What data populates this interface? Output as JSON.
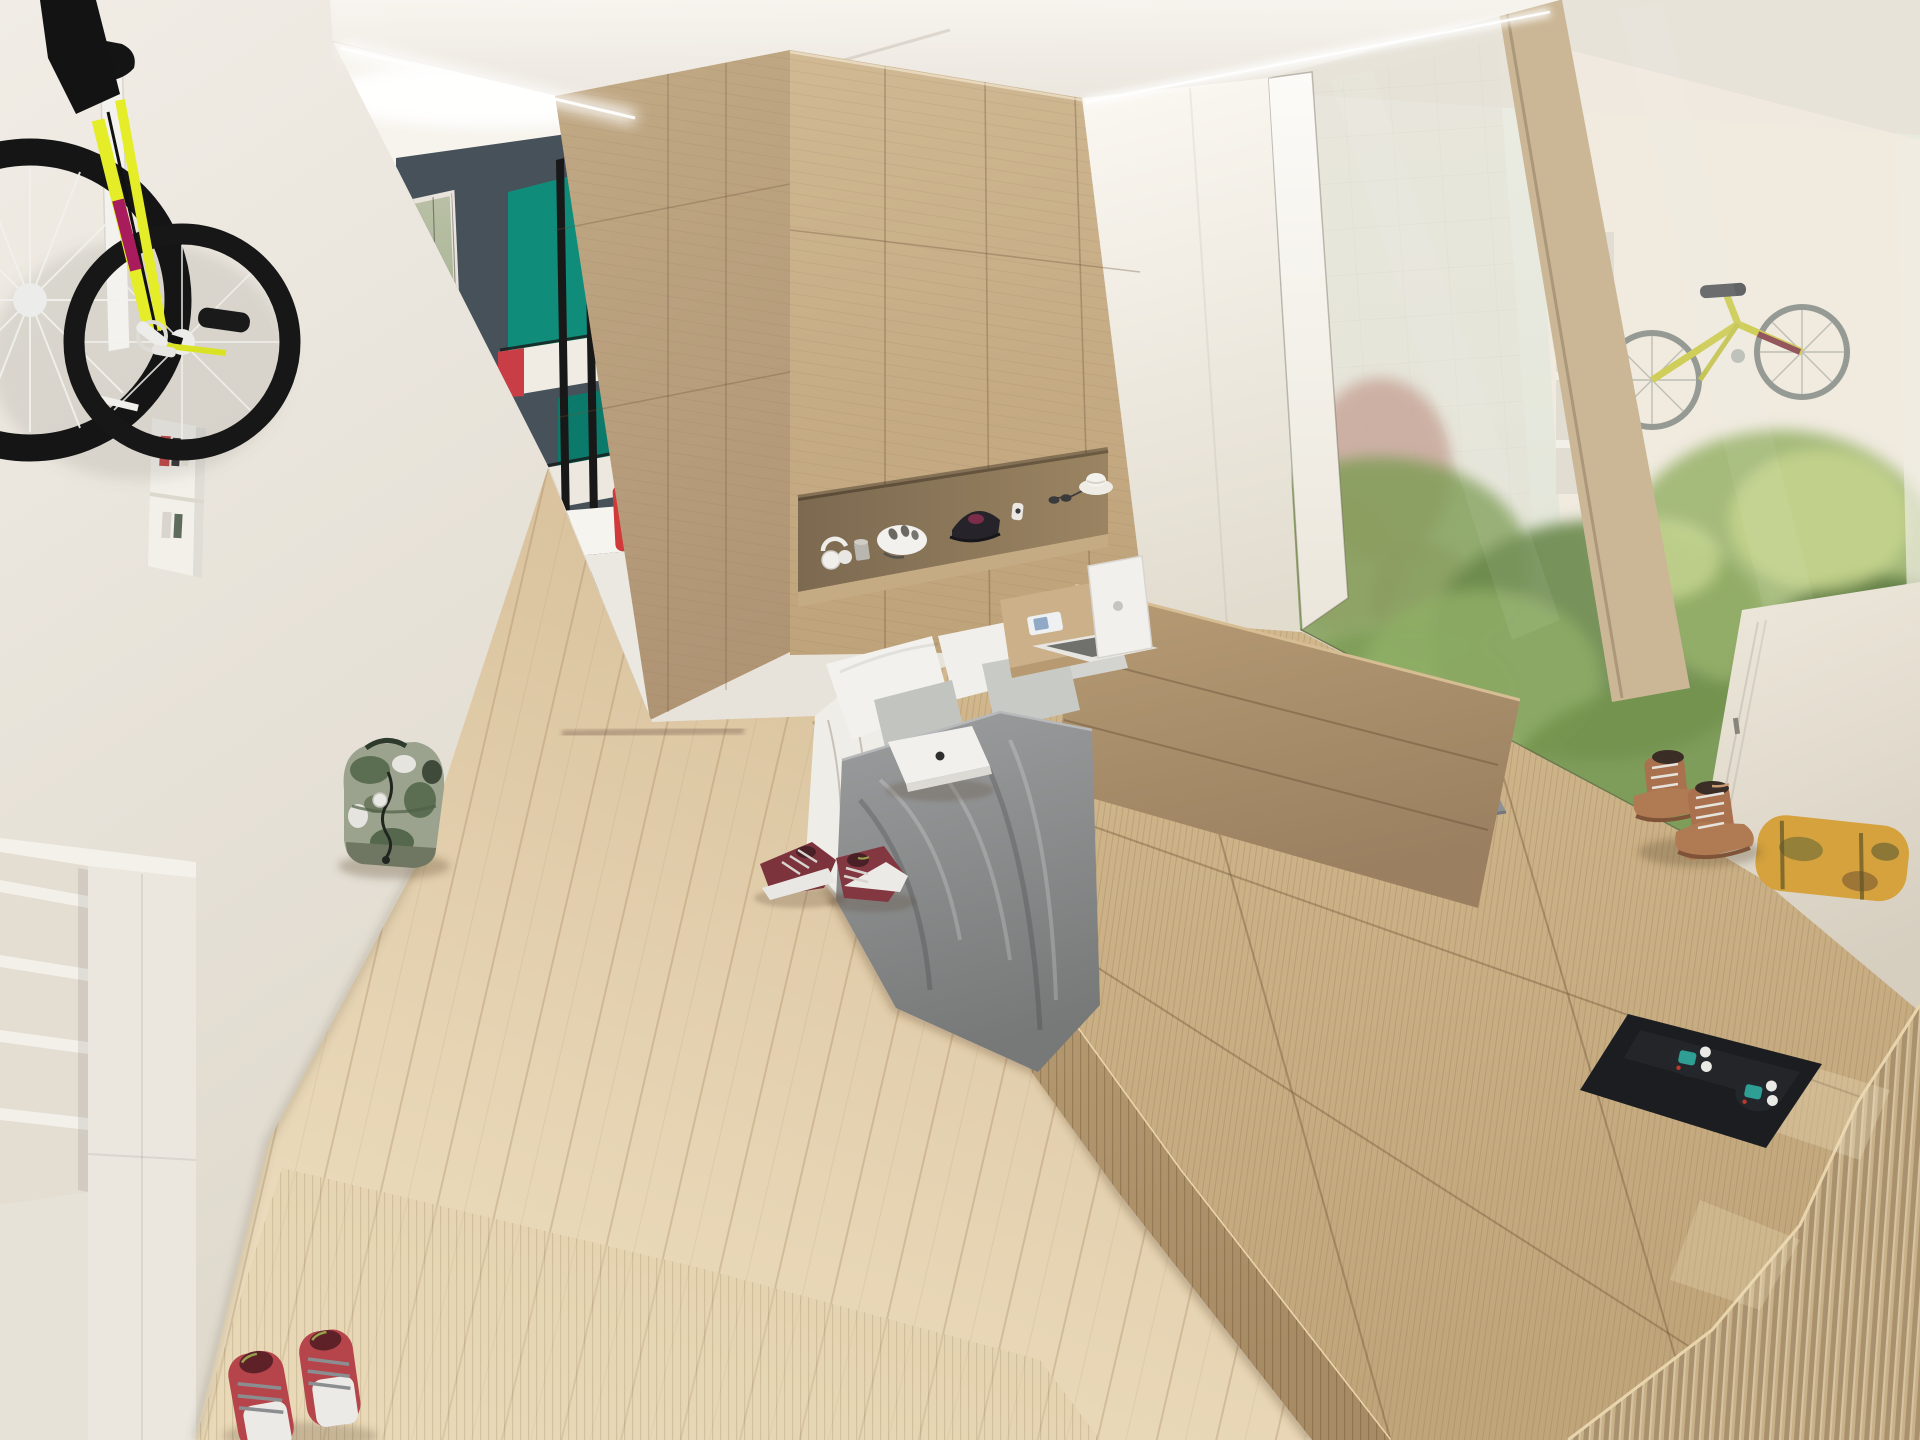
{
  "scene": {
    "kind": "architectural-interior-render",
    "view": "studio micro-apartment: raised tatami platform bed, kitchen nook, garden-facing glazed wall",
    "lighting": "daylight with recessed cove lighting"
  },
  "palette": {
    "wall": "#f0ece5",
    "wall_dark": "#dfd9cd",
    "ceiling": "#f6f3ed",
    "cove": "#ffffff",
    "slate": "#47515a",
    "teal": "#0f8d7a",
    "teal_dark": "#0c7a6a",
    "red": "#d23a3a",
    "red_book": "#c14a42",
    "blue_book": "#477fb0",
    "black_frame": "#181818",
    "wood_wall": "#cbb28c",
    "wood_wall_side": "#bca380",
    "niche_back": "#8e7a5d",
    "niche_shelf": "#c4ab83",
    "headboard": "#ab9069",
    "floor": "#dcc5a1",
    "platform": "#cbb189",
    "platform_step": "#b2976e",
    "mullion": "#cbb796",
    "cream_wall": "#efe9df",
    "blanket": "#8d8f90",
    "pillow": "#f2f1ed",
    "pillow_gray": "#c8cac6",
    "sheet": "#efede8",
    "fridge": "#ebe8e2",
    "counter_top": "#f6f4ef",
    "bike_yellow": "#e4ed27",
    "bike_black": "#151515",
    "bike_magenta": "#a81b5c",
    "bike2_yellow": "#cccc4e",
    "bike2_gray": "#8f948e",
    "laptop_white": "#f1f0ec",
    "laptop_gray": "#8e9194",
    "boots": "#a9714e",
    "boots_light": "#b07a52",
    "tray": "#1b1d20",
    "controller_teal": "#2f9e94",
    "cushion_yellow": "#d5a23d",
    "corduroy": "#c8b088",
    "backpack": "#9ba38e",
    "backpack_dark": "#4e6046",
    "sneaker": "#7c333c",
    "shoe_red": "#b5444b",
    "shoe_white": "#eceae6",
    "green_1": "#7d9c54",
    "green_2": "#98b36a",
    "green_dark": "#5e7c45",
    "green_sunlit": "#cfdb92",
    "shrub_pink": "#bd8d80",
    "cabinet": "#ebe7df"
  },
  "objects": [
    {
      "name": "wall-mounted-track-bike",
      "colors": [
        "bike_yellow",
        "bike_black",
        "bike_magenta"
      ]
    },
    {
      "name": "book-niche",
      "colors": [
        "wall"
      ]
    },
    {
      "name": "built-in-cabinets",
      "colors": [
        "cabinet"
      ]
    },
    {
      "name": "herb-window-planters",
      "colors": [
        "green_1",
        "red"
      ]
    },
    {
      "name": "slate-kitchen-wall",
      "colors": [
        "slate"
      ]
    },
    {
      "name": "teal-kitchen-cabinets",
      "colors": [
        "teal",
        "red",
        "black_frame"
      ]
    },
    {
      "name": "coffee-machine",
      "colors": [
        "red"
      ]
    },
    {
      "name": "mini-fridge-counter",
      "colors": [
        "fridge",
        "counter_top"
      ]
    },
    {
      "name": "oak-feature-wall",
      "colors": [
        "wood_wall",
        "wood_wall_side"
      ]
    },
    {
      "name": "display-niche",
      "items": [
        "headphones",
        "tape-roll",
        "bicycle-helmet",
        "baseball-cap",
        "smartwatch",
        "sunglasses",
        "hat"
      ]
    },
    {
      "name": "bed",
      "colors": [
        "sheet",
        "pillow",
        "pillow_gray",
        "blanket",
        "headboard"
      ]
    },
    {
      "name": "swing-bed-tray-with-phone",
      "colors": [
        "platform"
      ]
    },
    {
      "name": "open-laptop",
      "colors": [
        "laptop_white"
      ]
    },
    {
      "name": "closed-laptop-white",
      "colors": [
        "laptop_white"
      ]
    },
    {
      "name": "closed-laptop-gray",
      "colors": [
        "laptop_gray"
      ]
    },
    {
      "name": "tatami-platform",
      "colors": [
        "platform",
        "platform_step"
      ]
    },
    {
      "name": "leather-boots",
      "colors": [
        "boots",
        "boots_light"
      ]
    },
    {
      "name": "media-tray-with-controllers",
      "colors": [
        "tray",
        "controller_teal"
      ]
    },
    {
      "name": "camo-bolster-cushion",
      "colors": [
        "cushion_yellow"
      ]
    },
    {
      "name": "ribbed-throw",
      "colors": [
        "corduroy"
      ]
    },
    {
      "name": "glazed-garden-wall",
      "colors": [
        "mullion",
        "green_1",
        "green_2",
        "shrub_pink"
      ]
    },
    {
      "name": "neighbor-unit-bookshelf",
      "colors": [
        "red_book",
        "blue_book"
      ]
    },
    {
      "name": "hanging-city-bike",
      "colors": [
        "bike2_yellow",
        "bike2_gray"
      ]
    },
    {
      "name": "camo-backpack",
      "colors": [
        "backpack",
        "backpack_dark"
      ]
    },
    {
      "name": "maroon-sneakers",
      "colors": [
        "sneaker"
      ]
    },
    {
      "name": "red-canvas-shoes",
      "colors": [
        "shoe_red",
        "shoe_white"
      ]
    },
    {
      "name": "oak-floor",
      "colors": [
        "floor"
      ]
    }
  ]
}
